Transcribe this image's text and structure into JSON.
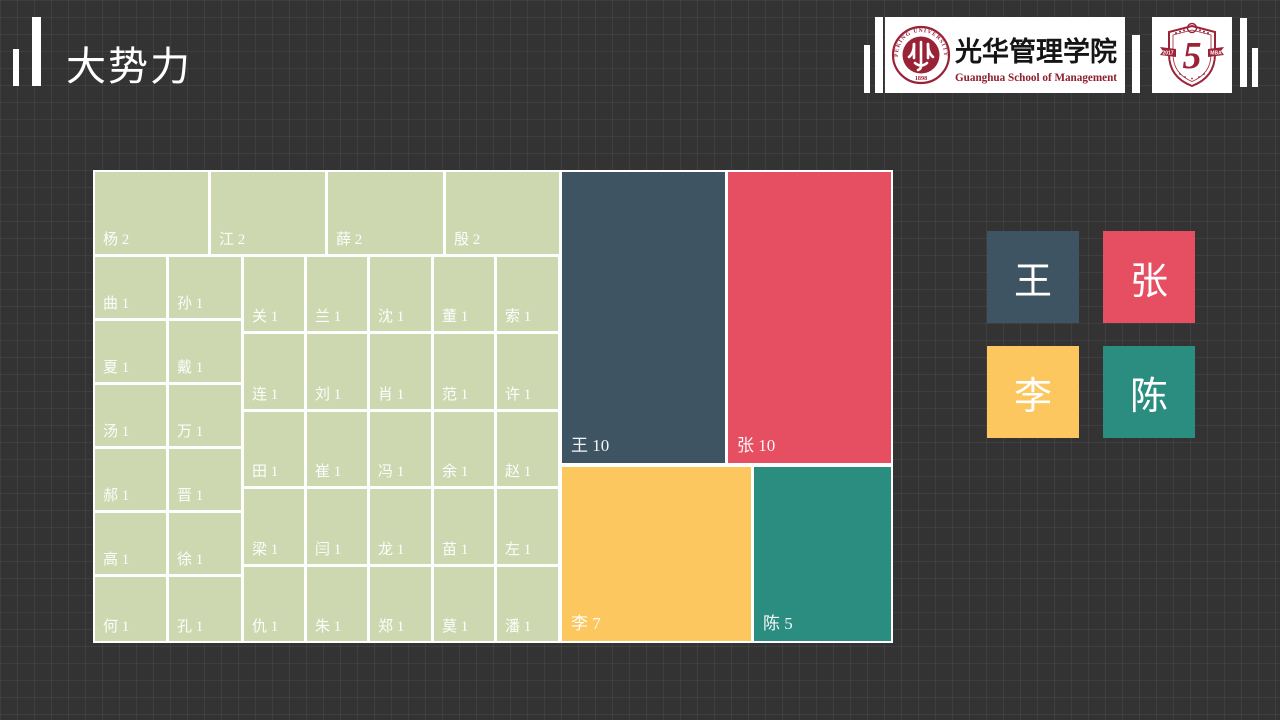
{
  "slide": {
    "title": "大势力"
  },
  "header": {
    "logo_guanghua": {
      "cn": "光华管理学院",
      "en": "Guanghua School of Management",
      "seal_top": "PEKING UNIVERSITY",
      "seal_bottom": "1898"
    },
    "logo_anniversary": {
      "number": "5",
      "ribbon_left": "2017",
      "ribbon_right": "MBA"
    }
  },
  "colors": {
    "background": "#333333",
    "grid_line": "rgba(255,255,255,0.055)",
    "wang_slate": "#3e5463",
    "zhang_red": "#e64e62",
    "li_yellow": "#fbc75e",
    "chen_teal": "#2b8d80",
    "minor_green": "#cdd8b1",
    "seal_red": "#9a2237"
  },
  "chart_data": {
    "type": "treemap",
    "title": "大势力",
    "description": "Surname frequency treemap",
    "legend_position": "right",
    "cells": [
      {
        "name": "王",
        "value": 10,
        "color": "#3e5463",
        "big": true,
        "x": 469,
        "y": 2,
        "w": 163,
        "h": 291
      },
      {
        "name": "张",
        "value": 10,
        "color": "#e64e62",
        "big": true,
        "x": 635,
        "y": 2,
        "w": 163,
        "h": 291
      },
      {
        "name": "李",
        "value": 7,
        "color": "#fbc75e",
        "big": true,
        "x": 469,
        "y": 297,
        "w": 189,
        "h": 174
      },
      {
        "name": "陈",
        "value": 5,
        "color": "#2b8d80",
        "big": true,
        "x": 661,
        "y": 297,
        "w": 137,
        "h": 174
      },
      {
        "name": "杨",
        "value": 2,
        "color": "#cdd8b1",
        "big": false,
        "x": 2,
        "y": 2,
        "w": 113,
        "h": 82
      },
      {
        "name": "江",
        "value": 2,
        "color": "#cdd8b1",
        "big": false,
        "x": 118,
        "y": 2,
        "w": 114,
        "h": 82
      },
      {
        "name": "薛",
        "value": 2,
        "color": "#cdd8b1",
        "big": false,
        "x": 235,
        "y": 2,
        "w": 115,
        "h": 82
      },
      {
        "name": "殷",
        "value": 2,
        "color": "#cdd8b1",
        "big": false,
        "x": 353,
        "y": 2,
        "w": 113,
        "h": 82
      },
      {
        "name": "曲",
        "value": 1,
        "color": "#cdd8b1",
        "big": false,
        "x": 2,
        "y": 87,
        "w": 71,
        "h": 61
      },
      {
        "name": "孙",
        "value": 1,
        "color": "#cdd8b1",
        "big": false,
        "x": 76,
        "y": 87,
        "w": 72,
        "h": 61
      },
      {
        "name": "夏",
        "value": 1,
        "color": "#cdd8b1",
        "big": false,
        "x": 2,
        "y": 151,
        "w": 71,
        "h": 61
      },
      {
        "name": "戴",
        "value": 1,
        "color": "#cdd8b1",
        "big": false,
        "x": 76,
        "y": 151,
        "w": 72,
        "h": 61
      },
      {
        "name": "汤",
        "value": 1,
        "color": "#cdd8b1",
        "big": false,
        "x": 2,
        "y": 215,
        "w": 71,
        "h": 61
      },
      {
        "name": "万",
        "value": 1,
        "color": "#cdd8b1",
        "big": false,
        "x": 76,
        "y": 215,
        "w": 72,
        "h": 61
      },
      {
        "name": "郝",
        "value": 1,
        "color": "#cdd8b1",
        "big": false,
        "x": 2,
        "y": 279,
        "w": 71,
        "h": 61
      },
      {
        "name": "晋",
        "value": 1,
        "color": "#cdd8b1",
        "big": false,
        "x": 76,
        "y": 279,
        "w": 72,
        "h": 61
      },
      {
        "name": "高",
        "value": 1,
        "color": "#cdd8b1",
        "big": false,
        "x": 2,
        "y": 343,
        "w": 71,
        "h": 61
      },
      {
        "name": "徐",
        "value": 1,
        "color": "#cdd8b1",
        "big": false,
        "x": 76,
        "y": 343,
        "w": 72,
        "h": 61
      },
      {
        "name": "何",
        "value": 1,
        "color": "#cdd8b1",
        "big": false,
        "x": 2,
        "y": 407,
        "w": 71,
        "h": 64
      },
      {
        "name": "孔",
        "value": 1,
        "color": "#cdd8b1",
        "big": false,
        "x": 76,
        "y": 407,
        "w": 72,
        "h": 64
      },
      {
        "name": "关",
        "value": 1,
        "color": "#cdd8b1",
        "big": false,
        "x": 151,
        "y": 87,
        "w": 60,
        "h": 74
      },
      {
        "name": "兰",
        "value": 1,
        "color": "#cdd8b1",
        "big": false,
        "x": 214,
        "y": 87,
        "w": 60,
        "h": 74
      },
      {
        "name": "沈",
        "value": 1,
        "color": "#cdd8b1",
        "big": false,
        "x": 277,
        "y": 87,
        "w": 61,
        "h": 74
      },
      {
        "name": "董",
        "value": 1,
        "color": "#cdd8b1",
        "big": false,
        "x": 341,
        "y": 87,
        "w": 60,
        "h": 74
      },
      {
        "name": "索",
        "value": 1,
        "color": "#cdd8b1",
        "big": false,
        "x": 404,
        "y": 87,
        "w": 61,
        "h": 74
      },
      {
        "name": "连",
        "value": 1,
        "color": "#cdd8b1",
        "big": false,
        "x": 151,
        "y": 164,
        "w": 60,
        "h": 75
      },
      {
        "name": "刘",
        "value": 1,
        "color": "#cdd8b1",
        "big": false,
        "x": 214,
        "y": 164,
        "w": 60,
        "h": 75
      },
      {
        "name": "肖",
        "value": 1,
        "color": "#cdd8b1",
        "big": false,
        "x": 277,
        "y": 164,
        "w": 61,
        "h": 75
      },
      {
        "name": "范",
        "value": 1,
        "color": "#cdd8b1",
        "big": false,
        "x": 341,
        "y": 164,
        "w": 60,
        "h": 75
      },
      {
        "name": "许",
        "value": 1,
        "color": "#cdd8b1",
        "big": false,
        "x": 404,
        "y": 164,
        "w": 61,
        "h": 75
      },
      {
        "name": "田",
        "value": 1,
        "color": "#cdd8b1",
        "big": false,
        "x": 151,
        "y": 242,
        "w": 60,
        "h": 74
      },
      {
        "name": "崔",
        "value": 1,
        "color": "#cdd8b1",
        "big": false,
        "x": 214,
        "y": 242,
        "w": 60,
        "h": 74
      },
      {
        "name": "冯",
        "value": 1,
        "color": "#cdd8b1",
        "big": false,
        "x": 277,
        "y": 242,
        "w": 61,
        "h": 74
      },
      {
        "name": "余",
        "value": 1,
        "color": "#cdd8b1",
        "big": false,
        "x": 341,
        "y": 242,
        "w": 60,
        "h": 74
      },
      {
        "name": "赵",
        "value": 1,
        "color": "#cdd8b1",
        "big": false,
        "x": 404,
        "y": 242,
        "w": 61,
        "h": 74
      },
      {
        "name": "梁",
        "value": 1,
        "color": "#cdd8b1",
        "big": false,
        "x": 151,
        "y": 319,
        "w": 60,
        "h": 75
      },
      {
        "name": "闫",
        "value": 1,
        "color": "#cdd8b1",
        "big": false,
        "x": 214,
        "y": 319,
        "w": 60,
        "h": 75
      },
      {
        "name": "龙",
        "value": 1,
        "color": "#cdd8b1",
        "big": false,
        "x": 277,
        "y": 319,
        "w": 61,
        "h": 75
      },
      {
        "name": "苗",
        "value": 1,
        "color": "#cdd8b1",
        "big": false,
        "x": 341,
        "y": 319,
        "w": 60,
        "h": 75
      },
      {
        "name": "左",
        "value": 1,
        "color": "#cdd8b1",
        "big": false,
        "x": 404,
        "y": 319,
        "w": 61,
        "h": 75
      },
      {
        "name": "仇",
        "value": 1,
        "color": "#cdd8b1",
        "big": false,
        "x": 151,
        "y": 397,
        "w": 60,
        "h": 74
      },
      {
        "name": "朱",
        "value": 1,
        "color": "#cdd8b1",
        "big": false,
        "x": 214,
        "y": 397,
        "w": 60,
        "h": 74
      },
      {
        "name": "郑",
        "value": 1,
        "color": "#cdd8b1",
        "big": false,
        "x": 277,
        "y": 397,
        "w": 61,
        "h": 74
      },
      {
        "name": "莫",
        "value": 1,
        "color": "#cdd8b1",
        "big": false,
        "x": 341,
        "y": 397,
        "w": 60,
        "h": 74
      },
      {
        "name": "潘",
        "value": 1,
        "color": "#cdd8b1",
        "big": false,
        "x": 404,
        "y": 397,
        "w": 61,
        "h": 74
      }
    ]
  },
  "legend": {
    "items": [
      {
        "label": "王",
        "color": "#3e5463"
      },
      {
        "label": "张",
        "color": "#e64e62"
      },
      {
        "label": "李",
        "color": "#fbc75e"
      },
      {
        "label": "陈",
        "color": "#2b8d80"
      }
    ]
  }
}
